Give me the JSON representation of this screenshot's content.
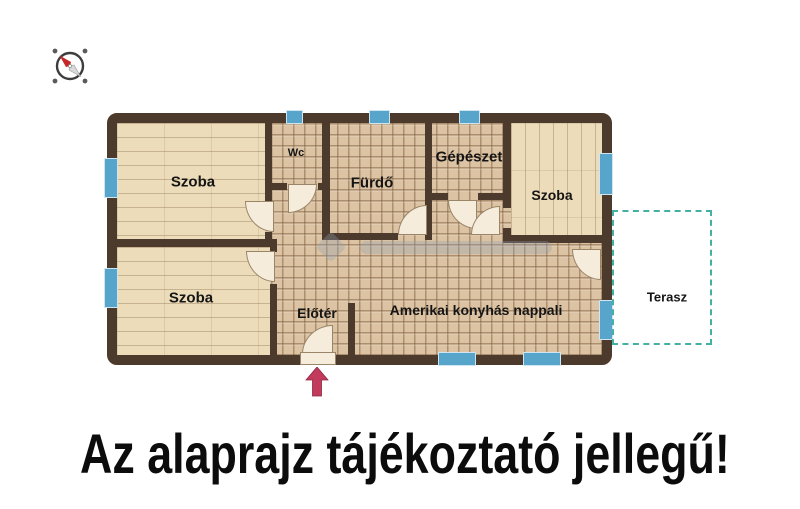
{
  "page": {
    "caption": "Az alaprajz tájékoztató jellegű!",
    "background": "#ffffff"
  },
  "floorplan": {
    "colors": {
      "wall": "#4c3a2d",
      "wood_floor": "#ecdcba",
      "tile_floor": "#dcc3a3",
      "window": "#58a5cb",
      "terrace_dash": "#44b0a2",
      "door_fill": "#f5ecdc",
      "entrance_arrow": "#c23a5c",
      "label_text": "#151515"
    },
    "rooms": [
      {
        "id": "szoba-top-left",
        "label": "Szoba",
        "floor": "wood"
      },
      {
        "id": "szoba-bottom-left",
        "label": "Szoba",
        "floor": "wood"
      },
      {
        "id": "wc",
        "label": "Wc",
        "floor": "tile"
      },
      {
        "id": "furdo",
        "label": "Fürdő",
        "floor": "tile"
      },
      {
        "id": "gepeszet",
        "label": "Gépészet",
        "floor": "tile"
      },
      {
        "id": "szoba-right",
        "label": "Szoba",
        "floor": "wood"
      },
      {
        "id": "eloter",
        "label": "Előtér",
        "floor": "tile"
      },
      {
        "id": "nappali",
        "label": "Amerikai konyhás nappali",
        "floor": "tile"
      },
      {
        "id": "terasz",
        "label": "Terasz",
        "floor": "outdoor"
      }
    ],
    "compass": {
      "icon": "compass-icon",
      "needle_direction": "north-west"
    },
    "entrance": {
      "icon": "entrance-arrow-icon",
      "direction": "up"
    },
    "windows_count": 9,
    "doors_count": 8
  }
}
